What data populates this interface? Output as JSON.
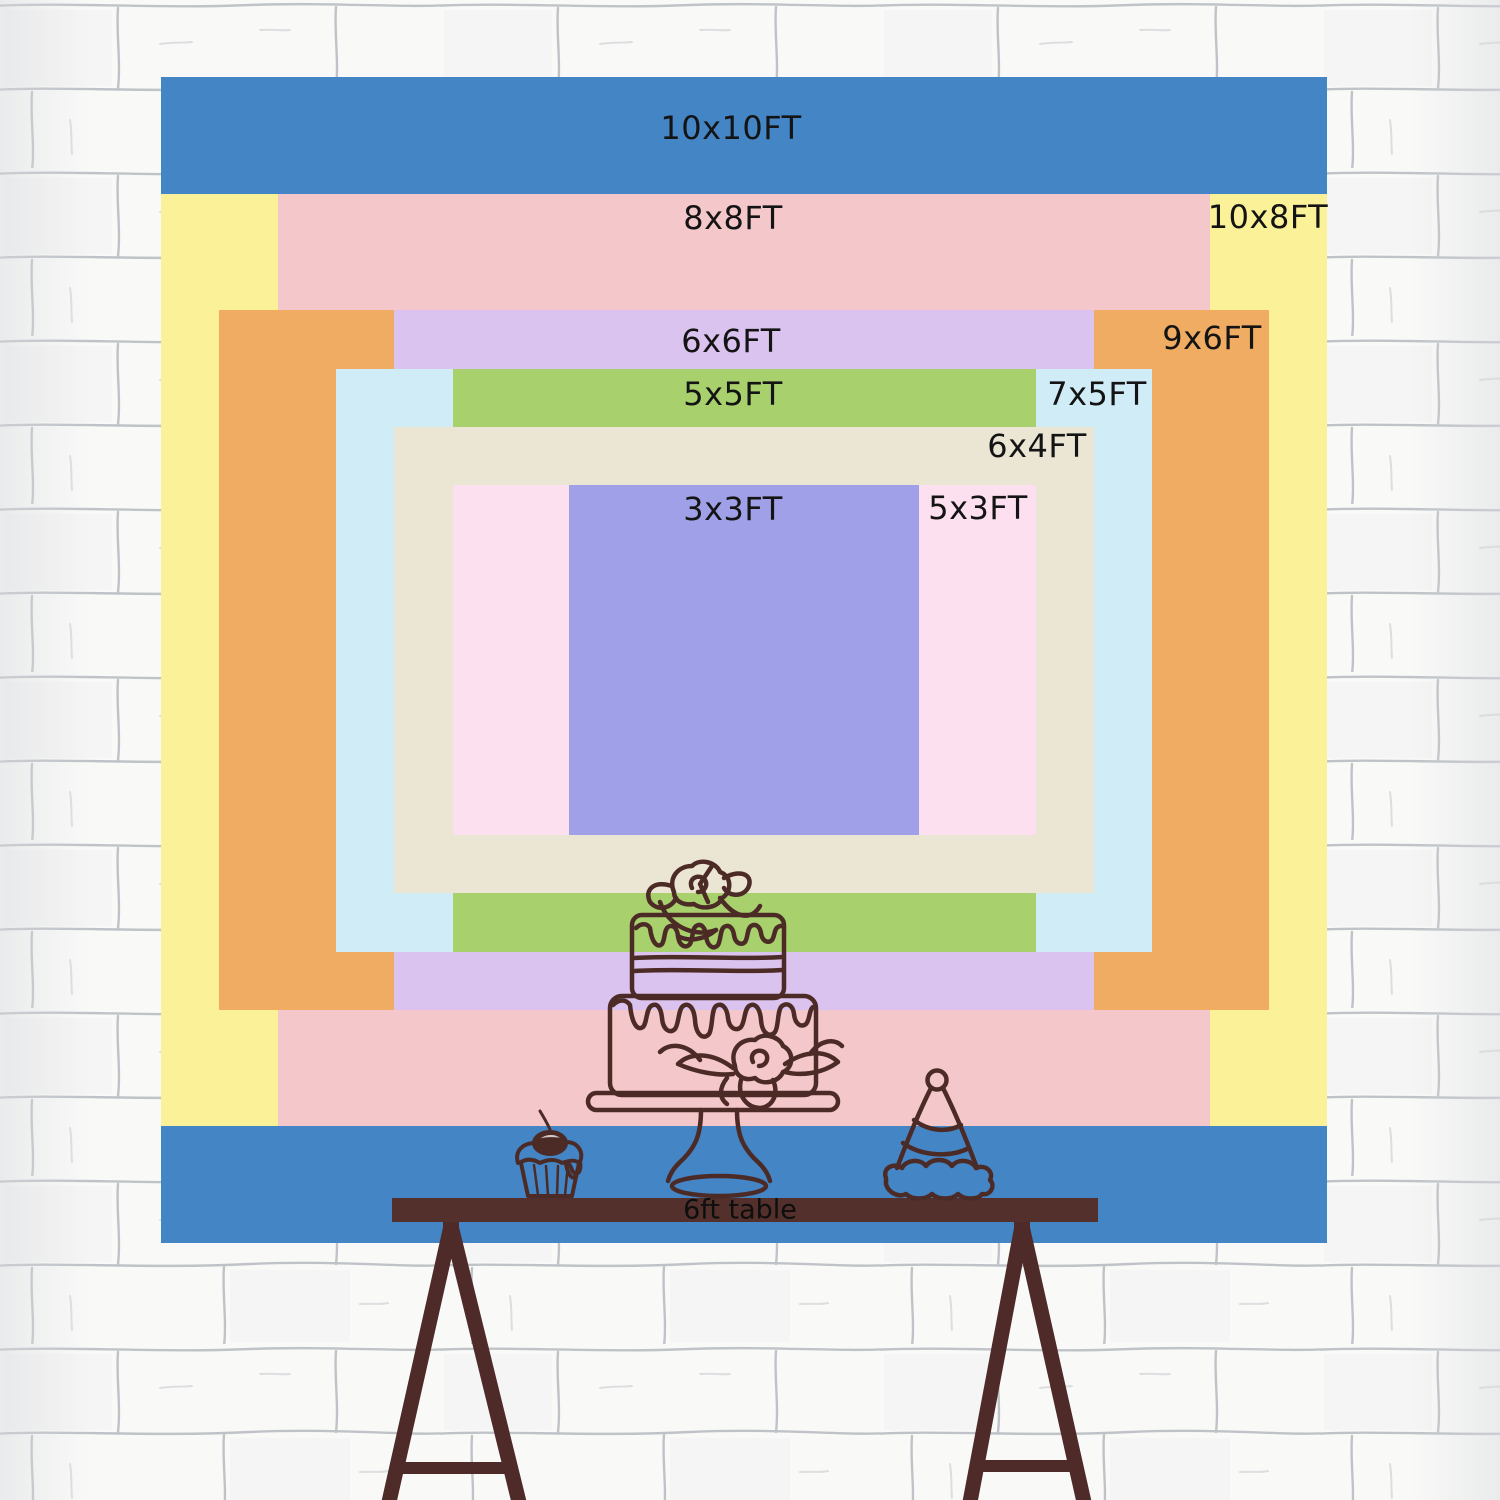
{
  "chart_data": {
    "type": "nested-rectangles-size-chart",
    "title": "Backdrop size comparison chart",
    "unit": "ft",
    "px_per_ft": 116.6,
    "center_px": {
      "x": 744,
      "y": 660
    },
    "label_color": "#141414",
    "sizes": [
      {
        "label": "10x10FT",
        "width_ft": 10,
        "height_ft": 10,
        "color": "#4485c5",
        "label_px": {
          "x": 731,
          "y": 128
        }
      },
      {
        "label": "10x8FT",
        "width_ft": 10,
        "height_ft": 8,
        "color": "#fbf198",
        "label_px": {
          "x": 1268,
          "y": 217
        }
      },
      {
        "label": "8x8FT",
        "width_ft": 8,
        "height_ft": 8,
        "color": "#f4c7ca",
        "label_px": {
          "x": 733,
          "y": 218
        }
      },
      {
        "label": "9x6FT",
        "width_ft": 9,
        "height_ft": 6,
        "color": "#efac62",
        "label_px": {
          "x": 1212,
          "y": 338
        }
      },
      {
        "label": "6x6FT",
        "width_ft": 6,
        "height_ft": 6,
        "color": "#dbc3ef",
        "label_px": {
          "x": 731,
          "y": 341
        }
      },
      {
        "label": "7x5FT",
        "width_ft": 7,
        "height_ft": 5,
        "color": "#cfecf7",
        "label_px": {
          "x": 1097,
          "y": 394
        }
      },
      {
        "label": "5x5FT",
        "width_ft": 5,
        "height_ft": 5,
        "color": "#a8d16e",
        "label_px": {
          "x": 733,
          "y": 394
        }
      },
      {
        "label": "6x4FT",
        "width_ft": 6,
        "height_ft": 4,
        "color": "#ebe6d3",
        "label_px": {
          "x": 1037,
          "y": 446
        }
      },
      {
        "label": "5x3FT",
        "width_ft": 5,
        "height_ft": 3,
        "color": "#fce0f0",
        "label_px": {
          "x": 978,
          "y": 508
        }
      },
      {
        "label": "3x3FT",
        "width_ft": 3,
        "height_ft": 3,
        "color": "#9fa0e7",
        "label_px": {
          "x": 733,
          "y": 509
        }
      }
    ],
    "table": {
      "label": "6ft table",
      "bar_color": "#53302c"
    },
    "illustration": {
      "ink_color": "#4c2b27",
      "items": [
        "cupcake-icon",
        "tiered-cake-icon",
        "party-hat-icon",
        "trestle-table"
      ]
    },
    "background": {
      "style": "white-brick-wall",
      "base_color": "#f9f9f8",
      "mortar_line_color": "#8f96a0"
    }
  }
}
